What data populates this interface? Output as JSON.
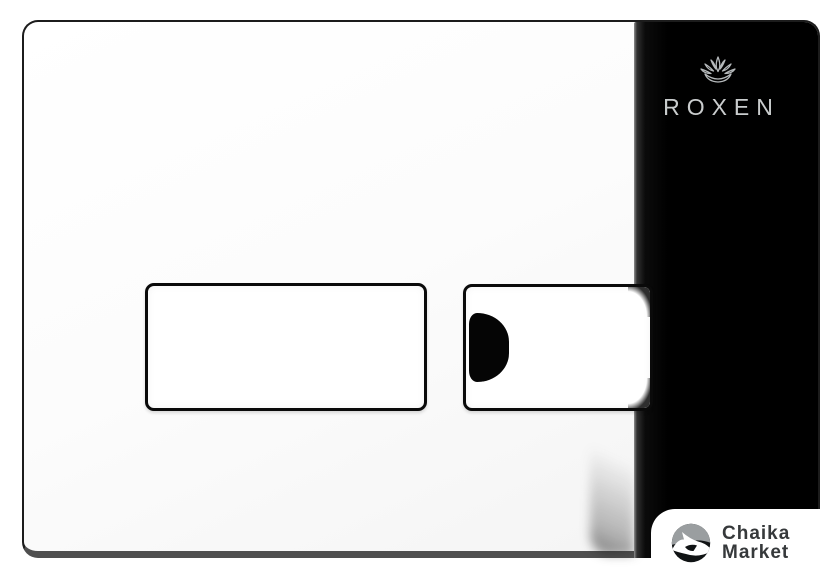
{
  "photo": {
    "description": "Chrome dual-button toilet flush plate product photo"
  },
  "brand": {
    "name": "ROXEN",
    "logo_icon": "lotus-icon",
    "text_color": "#c9cccd",
    "panel_color": "#000000"
  },
  "watermark": {
    "line1": "Chaika",
    "line2": "Market",
    "logo_icon": "seagull-icon",
    "text_color": "#36393b",
    "badge_color": "#ffffff"
  },
  "colors": {
    "background": "#ffffff",
    "plate_white": "#fbfbfb",
    "plate_edge": "#1c1c1c",
    "plate_bottom_edge": "#4f4f4f",
    "button_border": "#0a0a0a",
    "reflection_black": "#050505"
  }
}
